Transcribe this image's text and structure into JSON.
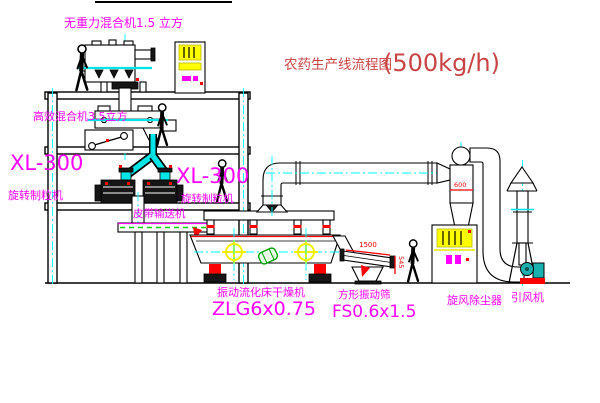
{
  "title": {
    "main": "农药生产线流程图",
    "capacity": "(500kg/h)"
  },
  "equipment": {
    "top_mixer_label": "无重力混合机1.5 立方",
    "mid_mixer_label": "高效混合机3.5立方",
    "granulator_left_model": "XL-300",
    "granulator_left_name": "旋转制粒机",
    "granulator_right_model": "XL-300",
    "granulator_right_name": "旋转制粒机",
    "conveyor_label": "皮带输送机",
    "dryer_name": "振动流化床干燥机",
    "dryer_model": "ZLG6x0.75",
    "screen_name": "方形振动筛",
    "screen_model": "FS0.6x1.5",
    "cyclone_label": "旋风除尘器",
    "fan_label": "引风机"
  },
  "dimensions": {
    "screen_length": "1500",
    "screen_height": "545",
    "cyclone_size": "600"
  },
  "colors": {
    "label_magenta": "#ff00ff",
    "title_red": "#c94444",
    "dimension_red": "#ff0000",
    "centerline_cyan": "#00ffff",
    "highlight_yellow": "#ffff00",
    "conveyor_green": "#00cc00",
    "fan_teal": "#1ab0b0"
  }
}
